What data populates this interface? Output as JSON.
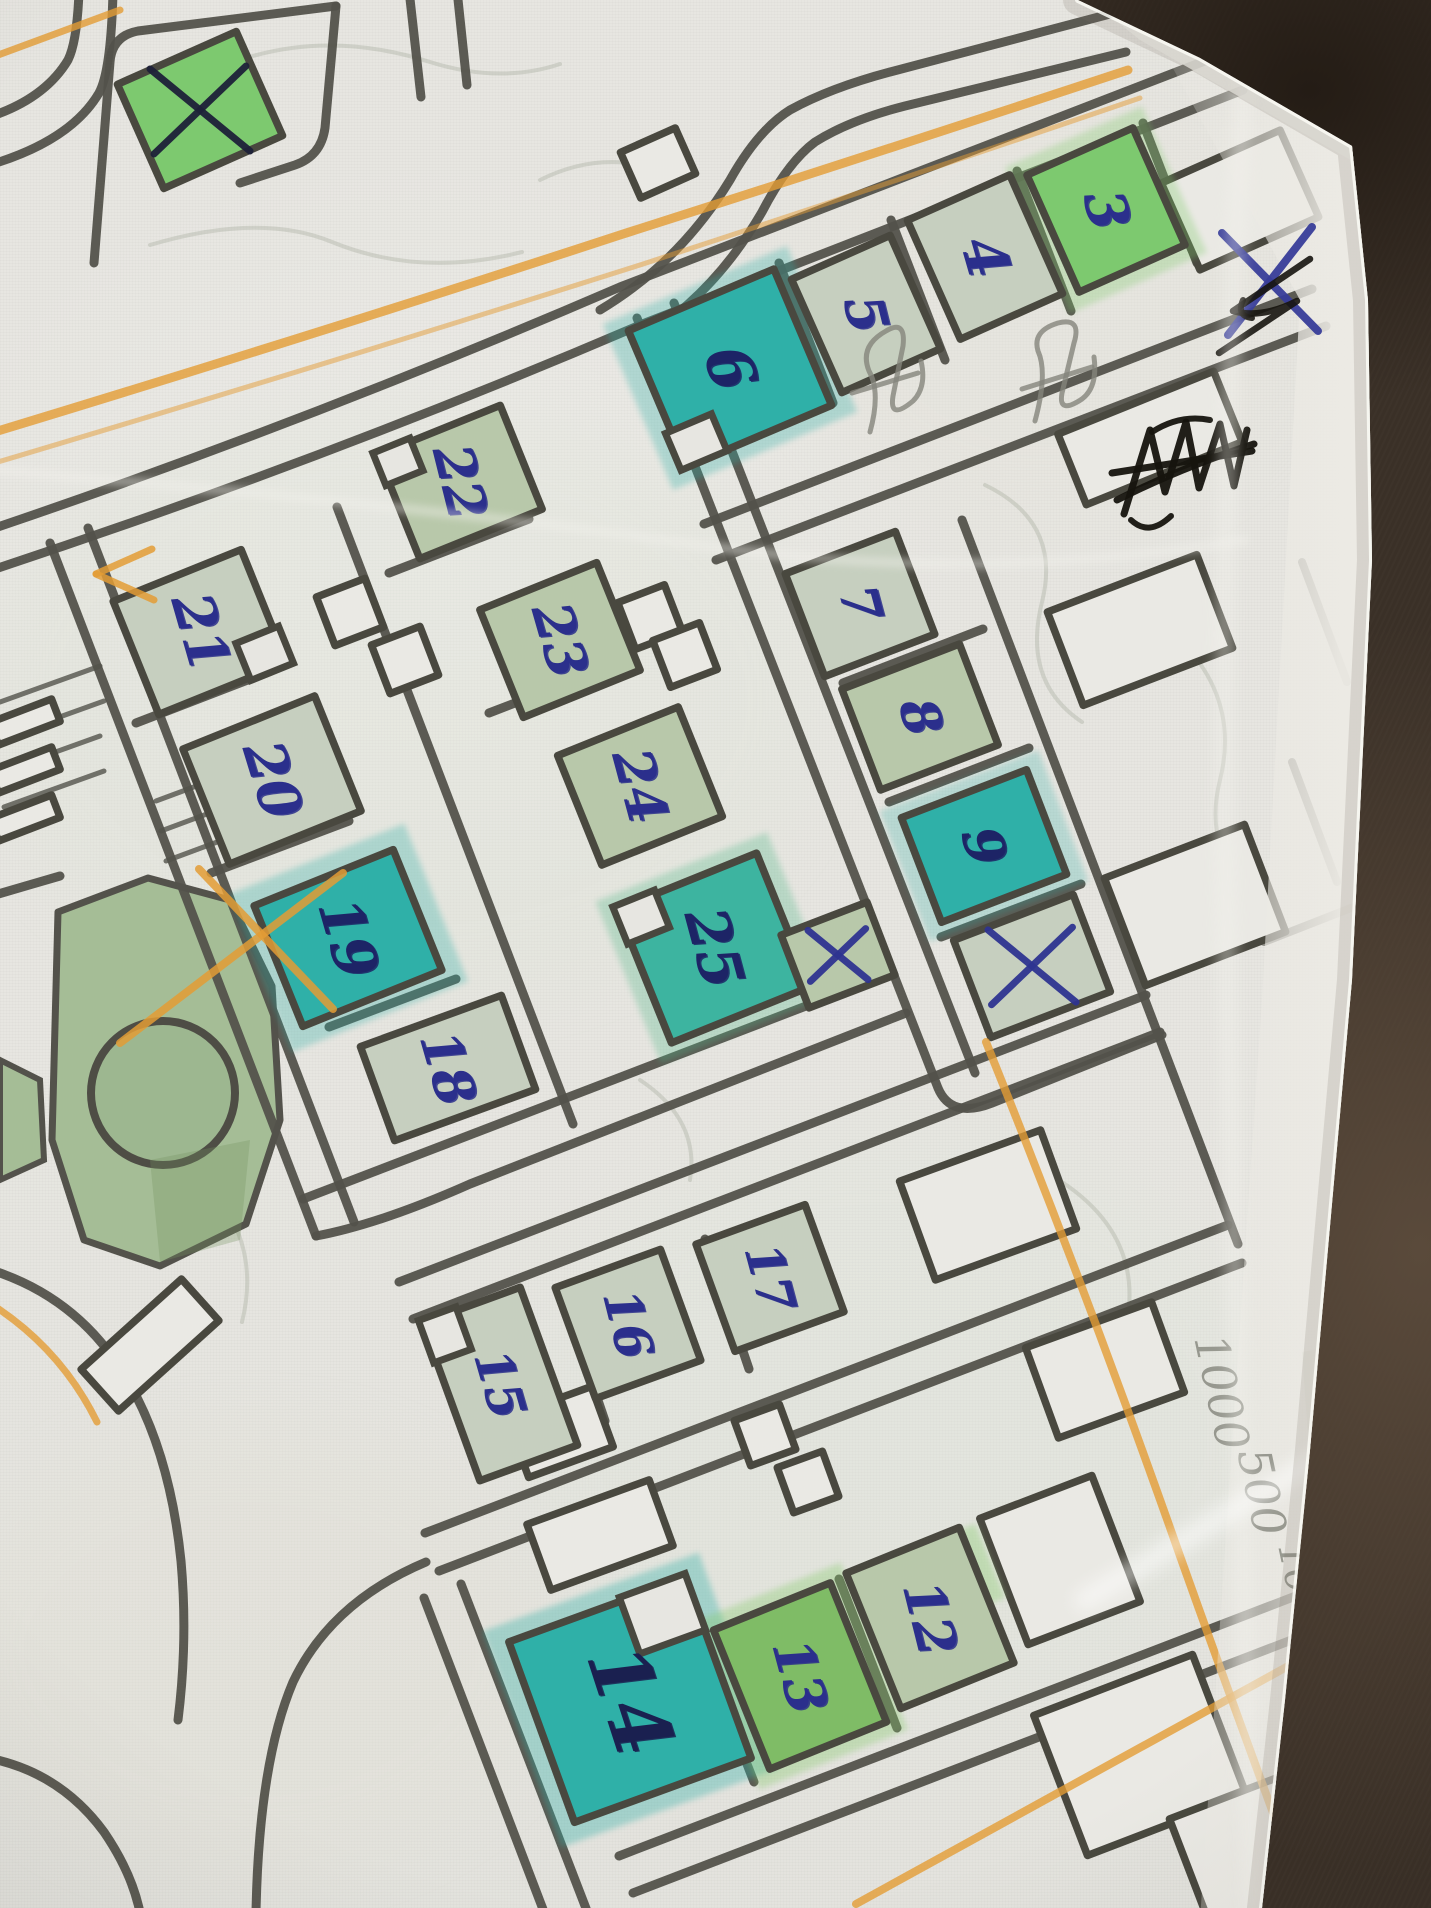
{
  "scene": {
    "background_color": "#3a3027",
    "paper_color": "#e7e6e1",
    "road_color": "#53524b",
    "building_outline_color": "#49483f",
    "number_ink_color": "#2b2f8c",
    "orange_pencil_color": "#e39c35",
    "pencil_color": "#84857c"
  },
  "map": {
    "fills": {
      "sage": "#c6cfbf",
      "sage2": "#b8c8aa",
      "green": "#7dc96f",
      "green2": "#7fbc66",
      "teal": "#2fb0a8",
      "teal2": "#3db4a0",
      "white": "#eae9e4"
    },
    "numbered_buildings": [
      {
        "n": "3",
        "cx": 1106,
        "cy": 210,
        "w": 116,
        "h": 128,
        "rot": -24,
        "fill": "green",
        "size": 56,
        "tilt": 76,
        "ink": "#2b2f8c"
      },
      {
        "n": "4",
        "cx": 985,
        "cy": 257,
        "w": 112,
        "h": 130,
        "rot": -24,
        "fill": "sage",
        "size": 58,
        "tilt": 74,
        "ink": "#2b2f8c"
      },
      {
        "n": "5",
        "cx": 866,
        "cy": 314,
        "w": 108,
        "h": 124,
        "rot": -24,
        "fill": "sage",
        "size": 54,
        "tilt": 76,
        "ink": "#2b2f8c"
      },
      {
        "n": "6",
        "cx": 730,
        "cy": 368,
        "w": 158,
        "h": 148,
        "rot": -23,
        "fill": "teal",
        "size": 62,
        "tilt": 72,
        "ink": "#1d2466"
      },
      {
        "n": "7",
        "cx": 860,
        "cy": 604,
        "w": 118,
        "h": 110,
        "rot": -21,
        "fill": "sage",
        "size": 52,
        "tilt": 75,
        "ink": "#2b2f8c"
      },
      {
        "n": "8",
        "cx": 920,
        "cy": 717,
        "w": 126,
        "h": 108,
        "rot": -21,
        "fill": "sage2",
        "size": 52,
        "tilt": 75,
        "ink": "#2b2f8c"
      },
      {
        "n": "9",
        "cx": 984,
        "cy": 846,
        "w": 134,
        "h": 112,
        "rot": -21,
        "fill": "teal",
        "size": 54,
        "tilt": 75,
        "ink": "#1d2466"
      },
      {
        "n": "21",
        "cx": 200,
        "cy": 632,
        "w": 138,
        "h": 122,
        "rot": -22,
        "fill": "sage",
        "size": 56,
        "tilt": 74,
        "ink": "#2b2f8c"
      },
      {
        "n": "22",
        "cx": 460,
        "cy": 482,
        "w": 132,
        "h": 112,
        "rot": -22,
        "fill": "sage2",
        "size": 54,
        "tilt": 76,
        "ink": "#2b2f8c"
      },
      {
        "n": "23",
        "cx": 560,
        "cy": 640,
        "w": 126,
        "h": 116,
        "rot": -22,
        "fill": "sage2",
        "size": 54,
        "tilt": 74,
        "ink": "#2b2f8c"
      },
      {
        "n": "20",
        "cx": 272,
        "cy": 780,
        "w": 142,
        "h": 124,
        "rot": -22,
        "fill": "sage",
        "size": 56,
        "tilt": 73,
        "ink": "#2b2f8c"
      },
      {
        "n": "24",
        "cx": 640,
        "cy": 786,
        "w": 130,
        "h": 118,
        "rot": -22,
        "fill": "sage2",
        "size": 54,
        "tilt": 75,
        "ink": "#2b2f8c"
      },
      {
        "n": "19",
        "cx": 348,
        "cy": 938,
        "w": 150,
        "h": 130,
        "rot": -22,
        "fill": "teal",
        "size": 58,
        "tilt": 74,
        "ink": "#1d2466"
      },
      {
        "n": "25",
        "cx": 714,
        "cy": 948,
        "w": 150,
        "h": 144,
        "rot": -22,
        "fill": "teal2",
        "size": 58,
        "tilt": 75,
        "ink": "#1d2466"
      },
      {
        "n": "18",
        "cx": 448,
        "cy": 1068,
        "w": 150,
        "h": 100,
        "rot": -20,
        "fill": "sage",
        "size": 54,
        "tilt": 74,
        "ink": "#2b2f8c"
      },
      {
        "n": "17",
        "cx": 770,
        "cy": 1278,
        "w": 116,
        "h": 114,
        "rot": -20,
        "fill": "sage",
        "size": 50,
        "tilt": 75,
        "ink": "#2b2f8c"
      },
      {
        "n": "16",
        "cx": 628,
        "cy": 1324,
        "w": 112,
        "h": 118,
        "rot": -20,
        "fill": "sage",
        "size": 50,
        "tilt": 76,
        "ink": "#2b2f8c"
      },
      {
        "n": "15",
        "cx": 500,
        "cy": 1384,
        "w": 104,
        "h": 168,
        "rot": -20,
        "fill": "sage",
        "size": 50,
        "tilt": 74,
        "ink": "#2b2f8c"
      },
      {
        "n": "14",
        "cx": 630,
        "cy": 1700,
        "w": 188,
        "h": 192,
        "rot": -20,
        "fill": "teal",
        "size": 80,
        "tilt": 72,
        "ink": "#1a2050"
      },
      {
        "n": "13",
        "cx": 800,
        "cy": 1676,
        "w": 126,
        "h": 150,
        "rot": -22,
        "fill": "green2",
        "size": 54,
        "tilt": 75,
        "ink": "#2b2f8c"
      },
      {
        "n": "12",
        "cx": 930,
        "cy": 1618,
        "w": 122,
        "h": 146,
        "rot": -22,
        "fill": "sage2",
        "size": 54,
        "tilt": 76,
        "ink": "#2b2f8c"
      }
    ],
    "x_marked_buildings": [
      {
        "id": "top-left",
        "cx": 200,
        "cy": 110,
        "w": 130,
        "h": 114,
        "rot": -24,
        "fill": "green",
        "xcolor": "#1d2138",
        "xr": 50
      },
      {
        "id": "below-9",
        "cx": 1032,
        "cy": 966,
        "w": 128,
        "h": 104,
        "rot": -21,
        "fill": "sage",
        "xcolor": "#2e3490",
        "xr": 44
      },
      {
        "id": "beside-25",
        "cx": 838,
        "cy": 955,
        "w": 92,
        "h": 78,
        "rot": -21,
        "fill": "sage2",
        "xcolor": "#2e3490",
        "xr": 30
      }
    ],
    "unlabeled_buildings": [
      {
        "cx": 1150,
        "cy": 438,
        "w": 168,
        "h": 76,
        "rot": -22
      },
      {
        "cx": 1240,
        "cy": 200,
        "w": 130,
        "h": 95,
        "rot": -24
      },
      {
        "cx": 1140,
        "cy": 630,
        "w": 160,
        "h": 100,
        "rot": -21
      },
      {
        "cx": 1195,
        "cy": 905,
        "w": 150,
        "h": 115,
        "rot": -21
      },
      {
        "cx": 988,
        "cy": 1205,
        "w": 150,
        "h": 105,
        "rot": -20
      },
      {
        "cx": 1105,
        "cy": 1370,
        "w": 134,
        "h": 96,
        "rot": -20
      },
      {
        "cx": 1060,
        "cy": 1560,
        "w": 120,
        "h": 135,
        "rot": -21
      },
      {
        "cx": 1140,
        "cy": 1755,
        "w": 170,
        "h": 150,
        "rot": -21
      },
      {
        "cx": 1285,
        "cy": 1855,
        "w": 190,
        "h": 150,
        "rot": -21
      },
      {
        "cx": 600,
        "cy": 1535,
        "w": 130,
        "h": 70,
        "rot": -20
      },
      {
        "cx": 560,
        "cy": 1432,
        "w": 90,
        "h": 64,
        "rot": -20
      },
      {
        "cx": 350,
        "cy": 612,
        "w": 52,
        "h": 52,
        "rot": -21
      },
      {
        "cx": 405,
        "cy": 660,
        "w": 52,
        "h": 52,
        "rot": -21
      },
      {
        "cx": 650,
        "cy": 617,
        "w": 50,
        "h": 50,
        "rot": -21
      },
      {
        "cx": 685,
        "cy": 655,
        "w": 50,
        "h": 50,
        "rot": -21
      },
      {
        "cx": 765,
        "cy": 1435,
        "w": 48,
        "h": 48,
        "rot": -20
      },
      {
        "cx": 808,
        "cy": 1482,
        "w": 48,
        "h": 48,
        "rot": -20
      },
      {
        "cx": 658,
        "cy": 163,
        "w": 60,
        "h": 50,
        "rot": -24
      },
      {
        "cx": 25,
        "cy": 722,
        "w": 66,
        "h": 24,
        "rot": -21
      },
      {
        "cx": 25,
        "cy": 770,
        "w": 66,
        "h": 24,
        "rot": -21
      },
      {
        "cx": 25,
        "cy": 818,
        "w": 66,
        "h": 24,
        "rot": -21
      },
      {
        "cx": 150,
        "cy": 1345,
        "w": 135,
        "h": 56,
        "rot": -42
      }
    ],
    "park": {
      "fill": "#a5bd96",
      "circle": {
        "cx": 163,
        "cy": 1093,
        "r": 72
      }
    }
  },
  "annotations": {
    "pencil_note_lines": [
      "1000",
      "500",
      "10"
    ],
    "black_crossout_scribble": true,
    "pen_x_on_paper_edge": true,
    "pencil_squiggle_count": 2,
    "orange_x_cross": true
  }
}
